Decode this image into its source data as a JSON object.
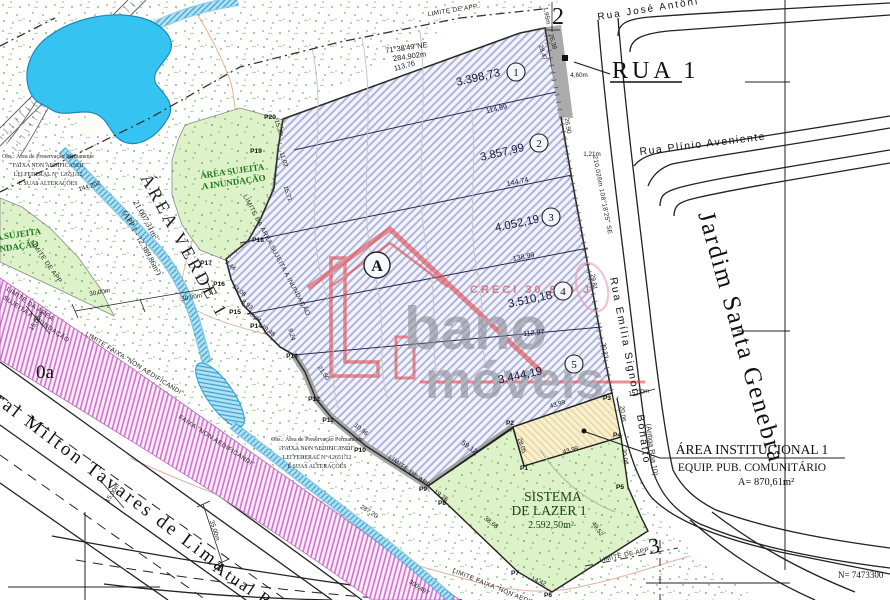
{
  "palette": {
    "water": "#35c4f2",
    "hatch": "#aeb3d8",
    "pink": "#cf6ecc",
    "stipple_green": "#5aa04a",
    "logo_red": "#e0474c",
    "inundacao_green": "#ddf2c8"
  },
  "streets": {
    "rua1": "RUA 1",
    "jose": "Rua José Antôni",
    "plinio": "Rua Plínio Aveniente",
    "emilia1": "Rua Emília Signori",
    "emilia2": "Bonatto",
    "antiga": "(Antiga Rua 10)",
    "milton": "ral Milton Tavares de Lima",
    "atual": "Atual R",
    "jardim": "Jardim Santa Genebra"
  },
  "areas": {
    "verde": {
      "title": "ÁREA VERDE 1",
      "size": "21.007,31m²",
      "app": "(APP 1 - 12.389,86m²)"
    },
    "inundacao": {
      "l1": "ÁREA SUJEITA",
      "l2": "A INUNDAÇÃO"
    },
    "lazer": {
      "l1": "SISTEMA",
      "l2": "DE LAZER 1",
      "size": "2.592,50m²"
    },
    "institucional": {
      "title": "ÁREA INSTITUCIONAL 1",
      "sub": "EQUIP. PUB. COMUNITÁRIO",
      "size": "A= 870,61m²"
    },
    "block": "A"
  },
  "lots": [
    {
      "n": "1",
      "area": "3.398,73"
    },
    {
      "n": "2",
      "area": "3.857,99"
    },
    {
      "n": "3",
      "area": "4.052,19"
    },
    {
      "n": "4",
      "area": "3.510,18"
    },
    {
      "n": "5",
      "area": "3.444,19"
    }
  ],
  "survey": {
    "bearing_top": "71°38'49\"NE",
    "dist_top": "284,902m",
    "road": "210,026m  108°18'25\" SE"
  },
  "limits": {
    "app": "LIMITE DE APP",
    "inund1": "LIMITE DA ÁREA",
    "inund2": "SUJEITA A INUNDAÇÃO",
    "inund_full": "LIMITE DA ÁREA SUJEITA A INUNDAÇÃO",
    "faixa_l": "LIMITE FAIXA \"NON AEDIFICANDI\"",
    "faixa": "FAIXA \"NON AEDIFICANDI\""
  },
  "obs": {
    "l1": "Obs.: Área de Preservação Permanente",
    "l2": "\"FAIXA NON AEDIFICANDI\"",
    "l3": "LEI FEDERAL N° 12651/12",
    "l4": "E SUAS ALTERAÇÕES"
  },
  "marks": {
    "m2": "2",
    "m3": "3",
    "m0a": "0a",
    "north": "N= 7473300"
  },
  "watermark": {
    "creci": "CRECI 30.970 J",
    "t1": "bano",
    "t2": "móveis"
  },
  "points": [
    "P1",
    "P2",
    "P3",
    "P4",
    "P5",
    "P6",
    "P7",
    "P8",
    "P9",
    "P10",
    "P11",
    "P12",
    "P13",
    "P14",
    "P15",
    "P16",
    "P17",
    "P18",
    "P19",
    "P20"
  ],
  "m": [
    "113,76",
    "114,99",
    "144,74",
    "138,99",
    "112,97",
    "59,12",
    "43,99",
    "43,99",
    "28,05",
    "19,26",
    "38,68",
    "14,42",
    "49,52",
    "26,38",
    "28,47",
    "4,60m",
    "26,90",
    "1,21m",
    "29,81",
    "30,23",
    "15,00m",
    "20,06",
    "20,06",
    "15,39",
    "11,02",
    "15,71",
    "7,44",
    "13,08",
    "8,93",
    "10,24",
    "19,48",
    "9,24",
    "21,50",
    "10,96",
    "287,20",
    "300,497",
    "144.202",
    "35,00m",
    "15,00m",
    "15,00m",
    "30,00m",
    "30,00m",
    "1,95m"
  ]
}
